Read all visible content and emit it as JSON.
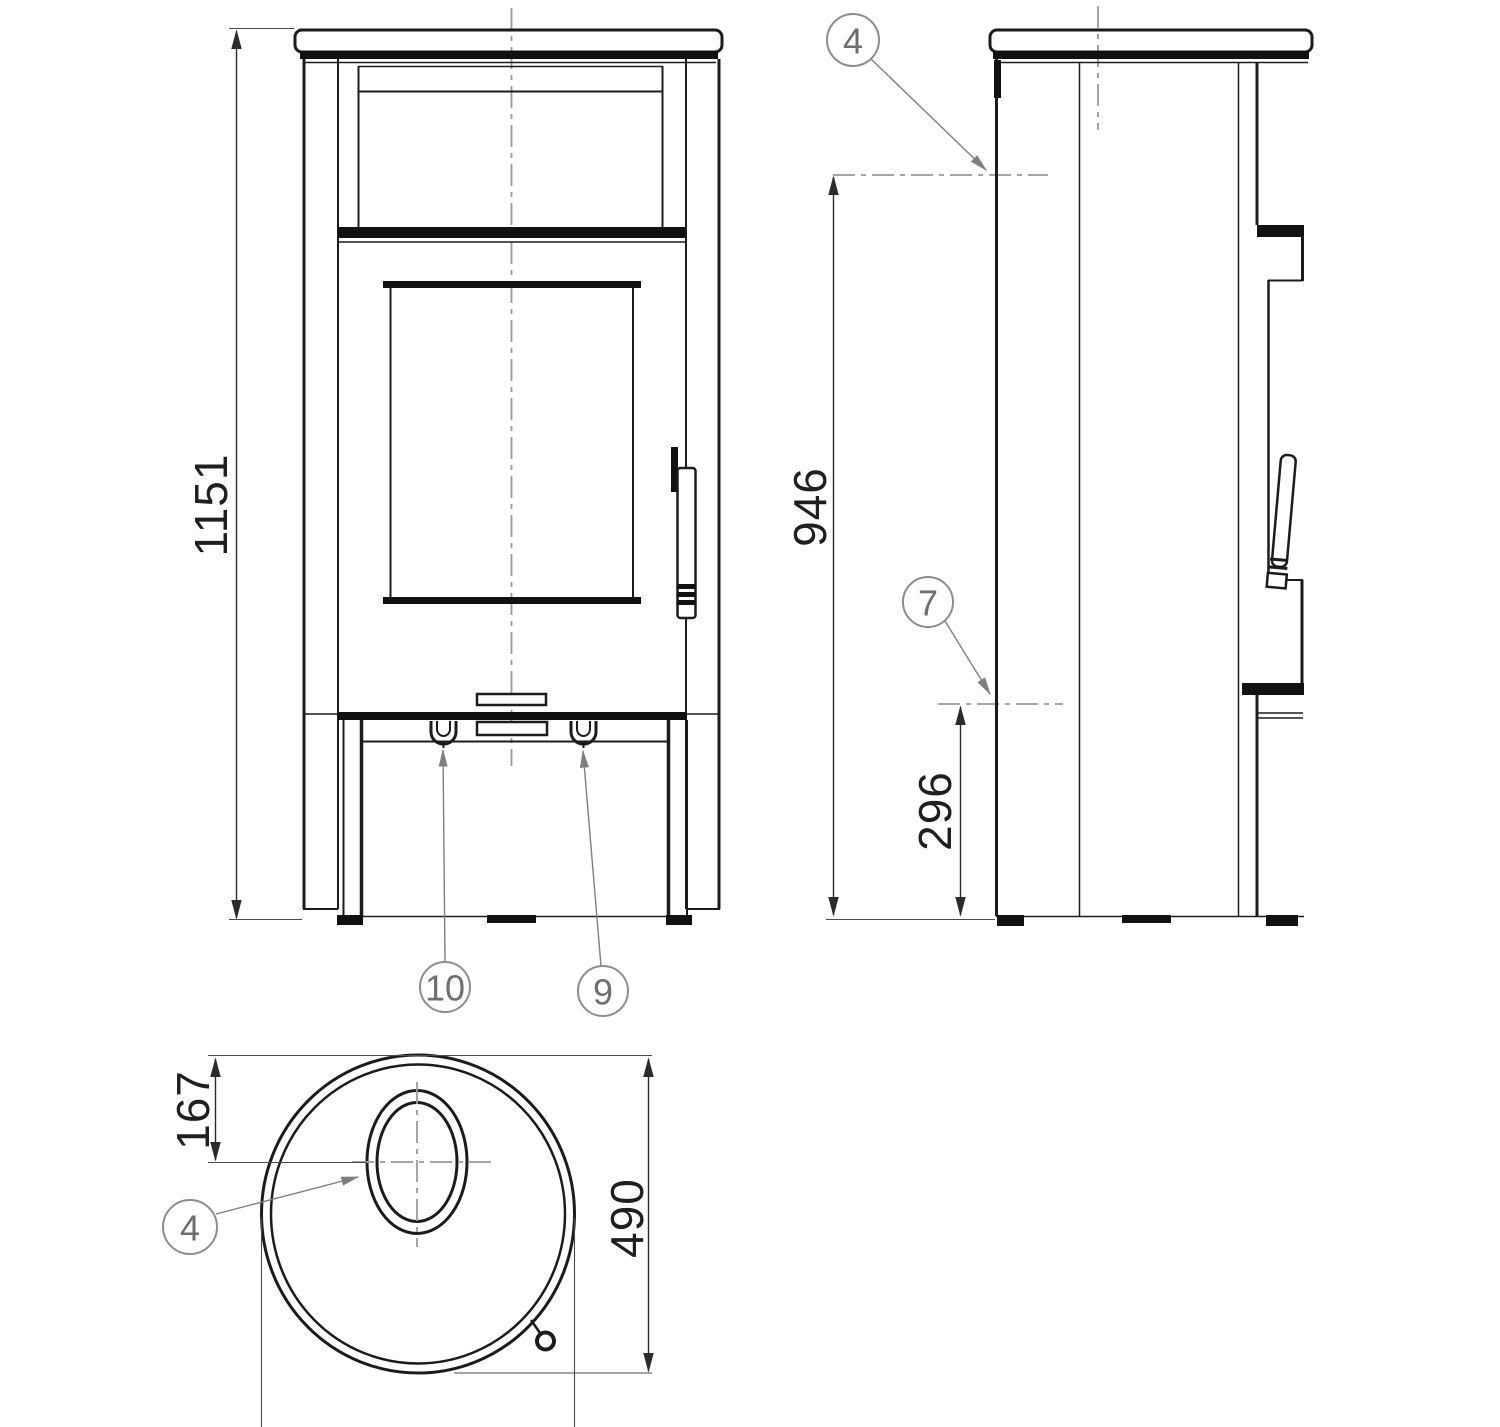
{
  "drawing": {
    "dimensions": {
      "overall_height": "1151",
      "rear_flue_center_height": "946",
      "rear_lower_connection_height": "296",
      "flue_center_from_front": "167",
      "depth": "490"
    },
    "callouts": {
      "side_top_flue": "4",
      "side_rear_connection": "7",
      "front_base_left": "10",
      "front_base_right": "9",
      "top_view_flue": "4"
    },
    "colors": {
      "line": "#1b1b1b",
      "dimension": "#2b2b2b",
      "leader": "#7f7f7f",
      "centerline": "#9a9a9a",
      "background": "#ffffff"
    }
  }
}
